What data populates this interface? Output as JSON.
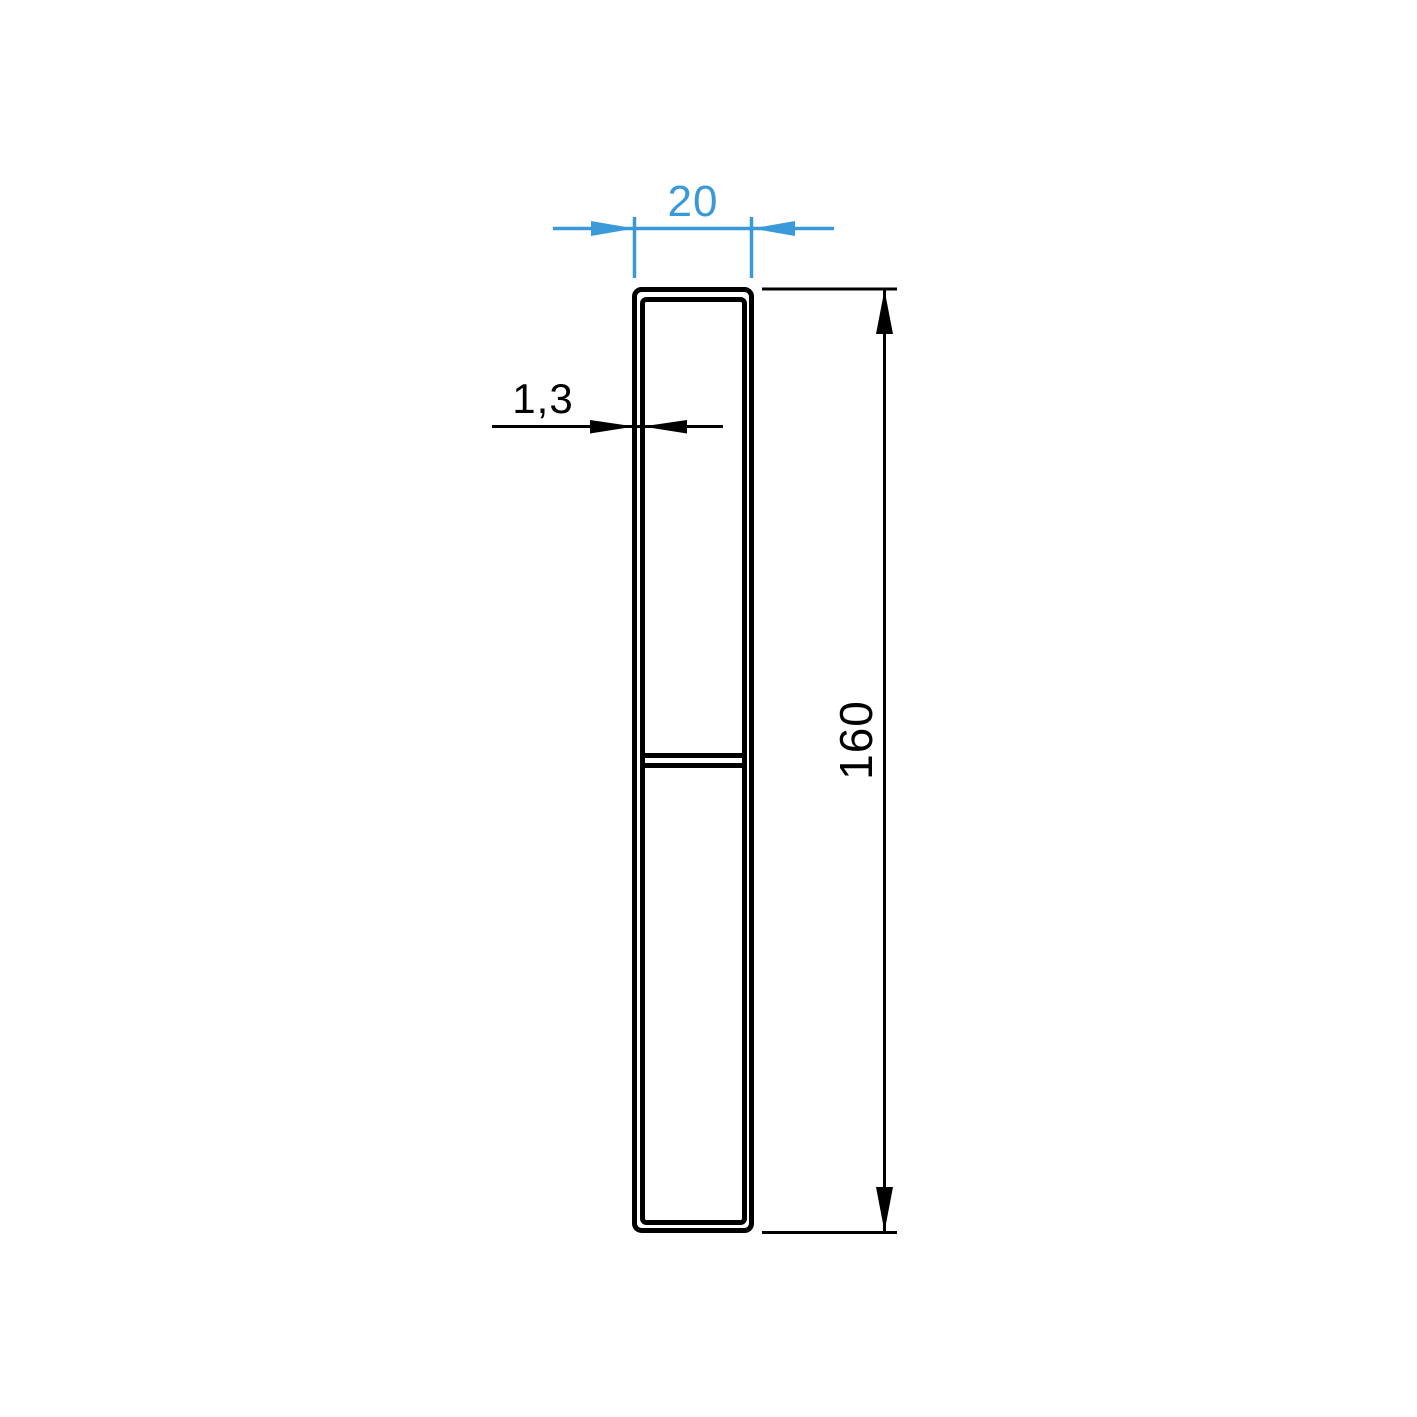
{
  "colors": {
    "dimension_accent_blue": "#3A9AD9",
    "drawing_ink": "#000000",
    "background": "#FFFFFF"
  },
  "drawing": {
    "labels": {
      "width": "20",
      "wall_thickness": "1,3",
      "height": "160"
    }
  }
}
